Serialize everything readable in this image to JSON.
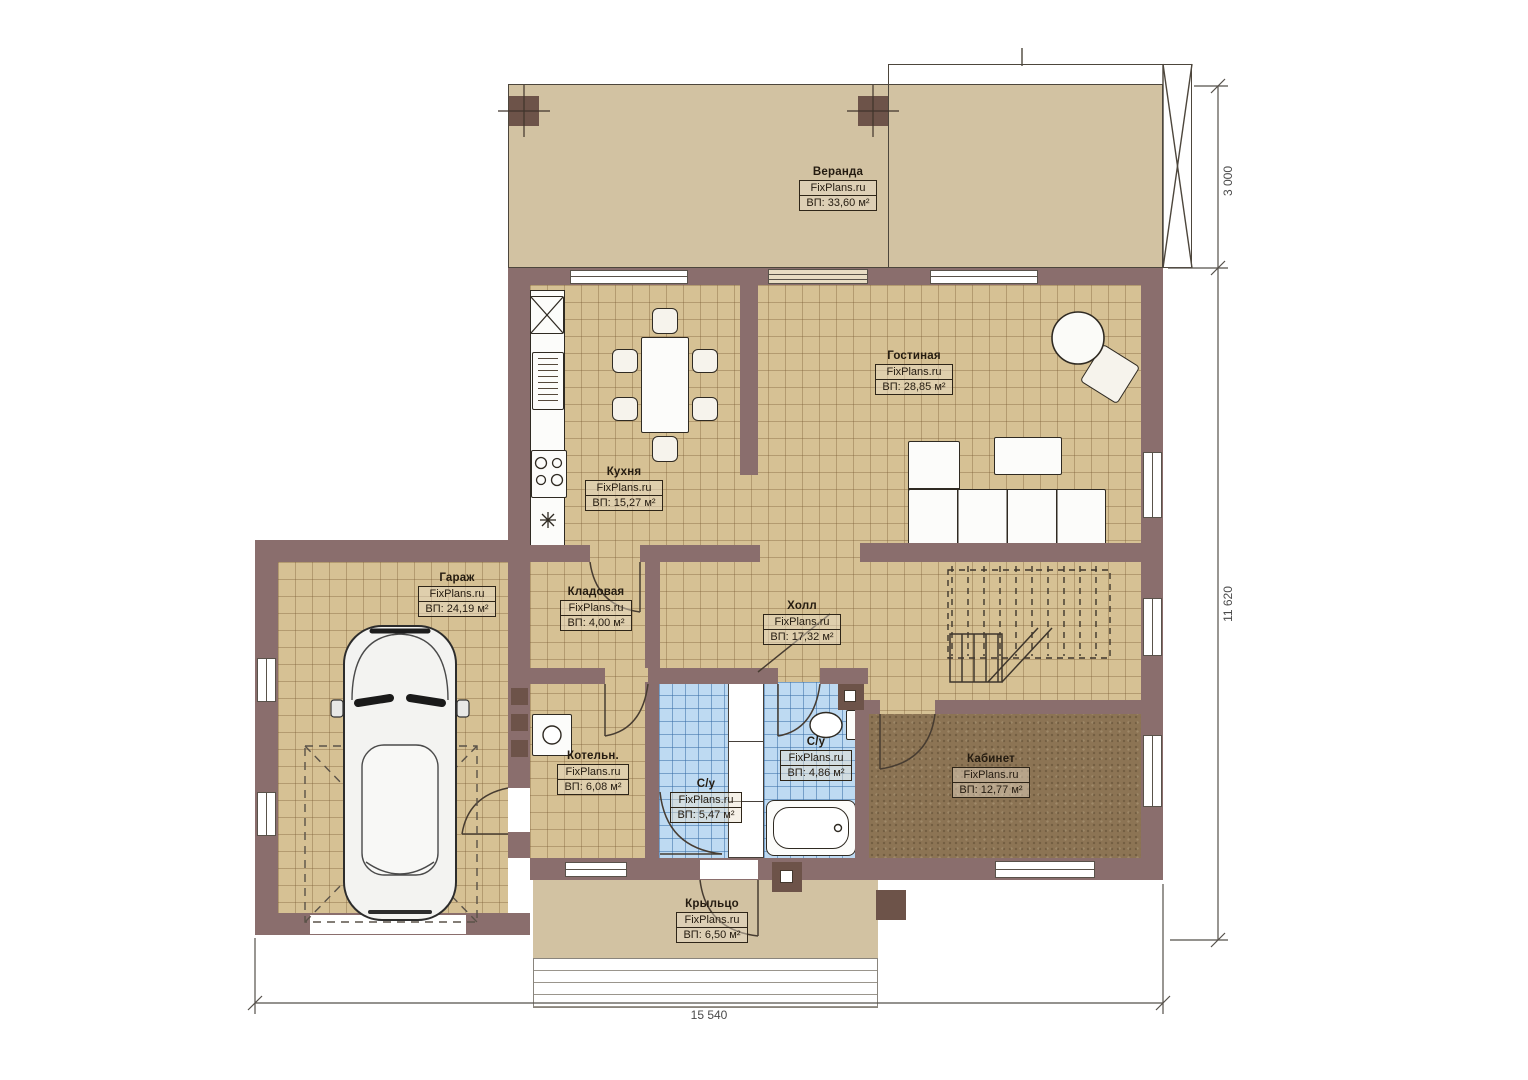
{
  "rooms": {
    "veranda": {
      "name": "Веранда",
      "brand": "FixPlans.ru",
      "area": "ВП: 33,60 м²"
    },
    "living": {
      "name": "Гостиная",
      "brand": "FixPlans.ru",
      "area": "ВП: 28,85 м²"
    },
    "kitchen": {
      "name": "Кухня",
      "brand": "FixPlans.ru",
      "area": "ВП: 15,27 м²"
    },
    "garage": {
      "name": "Гараж",
      "brand": "FixPlans.ru",
      "area": "ВП: 24,19 м²"
    },
    "storage": {
      "name": "Кладовая",
      "brand": "FixPlans.ru",
      "area": "ВП: 4,00 м²"
    },
    "hall": {
      "name": "Холл",
      "brand": "FixPlans.ru",
      "area": "ВП: 17,32 м²"
    },
    "boiler": {
      "name": "Котельн.",
      "brand": "FixPlans.ru",
      "area": "ВП: 6,08 м²"
    },
    "bath1": {
      "name": "С/у",
      "brand": "FixPlans.ru",
      "area": "ВП: 5,47 м²"
    },
    "bath2": {
      "name": "С/у",
      "brand": "FixPlans.ru",
      "area": "ВП: 4,86 м²"
    },
    "office": {
      "name": "Кабинет",
      "brand": "FixPlans.ru",
      "area": "ВП: 12,77 м²"
    },
    "porch": {
      "name": "Крыльцо",
      "brand": "FixPlans.ru",
      "area": "ВП: 6,50 м²"
    }
  },
  "dims": {
    "veranda": "3 000",
    "house_h": "11 620",
    "house_w": "15 540"
  },
  "colors": {
    "wall": "#8a6e6d",
    "column": "#6d5349",
    "floor_tile": "#d6c194",
    "veranda": "#d2c2a2",
    "bath_tile": "#bedaf2",
    "office_floor": "#8c7454",
    "outline": "#2f2a22"
  }
}
